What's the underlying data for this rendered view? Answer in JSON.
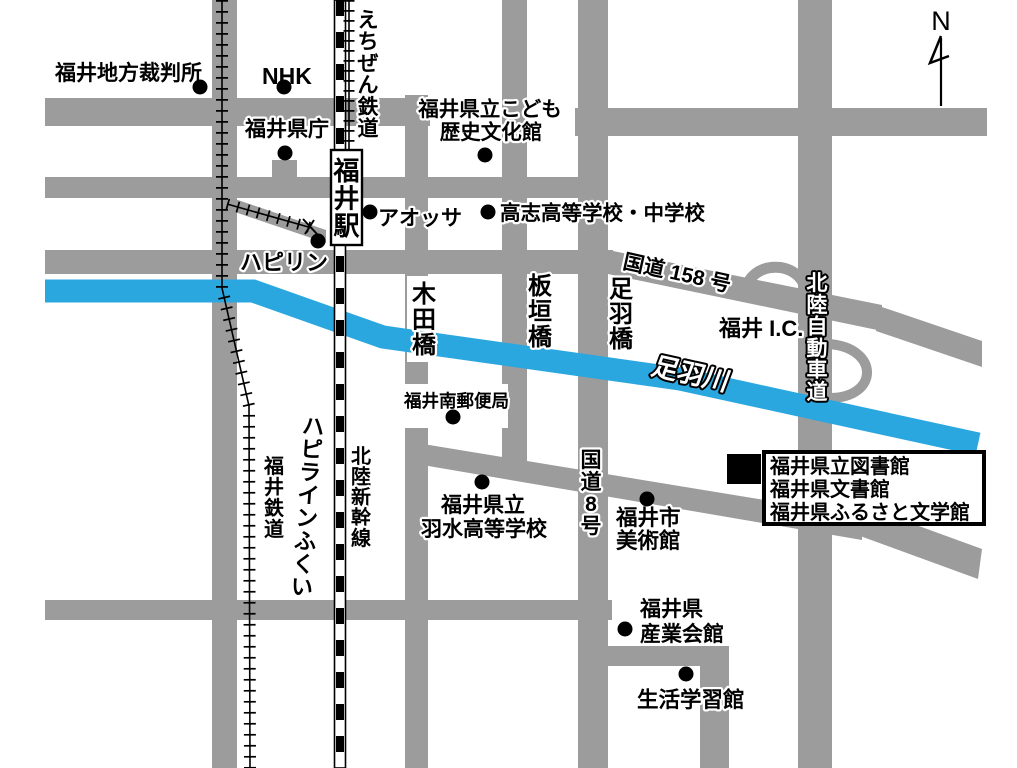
{
  "map": {
    "compass": {
      "north_label": "N"
    },
    "colors": {
      "road": "#9c9c9c",
      "river": "#2BA7E0",
      "marker": "#000000",
      "background": "#ffffff",
      "label_halo": "#ffffff"
    },
    "labels": {
      "district_court": "福井地方裁判所",
      "nhk": "NHK",
      "prefectural_office": "福井県庁",
      "children_history_museum_line1": "福井県立こども",
      "children_history_museum_line2": "歴史文化館",
      "fukui_station": "福井駅",
      "echizen_railway": "えちぜん鉄道",
      "aossa": "アオッサ",
      "koshi_school": "高志高等学校・中学校",
      "happiring": "ハピリン",
      "route_158": "国道 158 号",
      "fukui_ic": "福井 I.C.",
      "hokuriku_expressway": "北陸自動車道",
      "asuwa_river": "足羽川",
      "kida_bridge": "木田橋",
      "itagaki_bridge": "板垣橋",
      "asuwa_bridge": "足羽橋",
      "south_post_office": "福井南郵便局",
      "route_8": "国道8号",
      "fukui_railway": "福井鉄道",
      "hapiline_fukui": "ハピラインふくい",
      "hokuriku_shinkansen": "北陸新幹線",
      "usui_school_line1": "福井県立",
      "usui_school_line2": "羽水高等学校",
      "city_art_museum_line1": "福井市",
      "city_art_museum_line2": "美術館",
      "industry_hall_line1": "福井県",
      "industry_hall_line2": "産業会館",
      "lifelong_learning_center": "生活学習館"
    },
    "destination_box": {
      "line1": "福井県立図書館",
      "line2": "福井県文書館",
      "line3": "福井県ふるさと文学館"
    }
  }
}
